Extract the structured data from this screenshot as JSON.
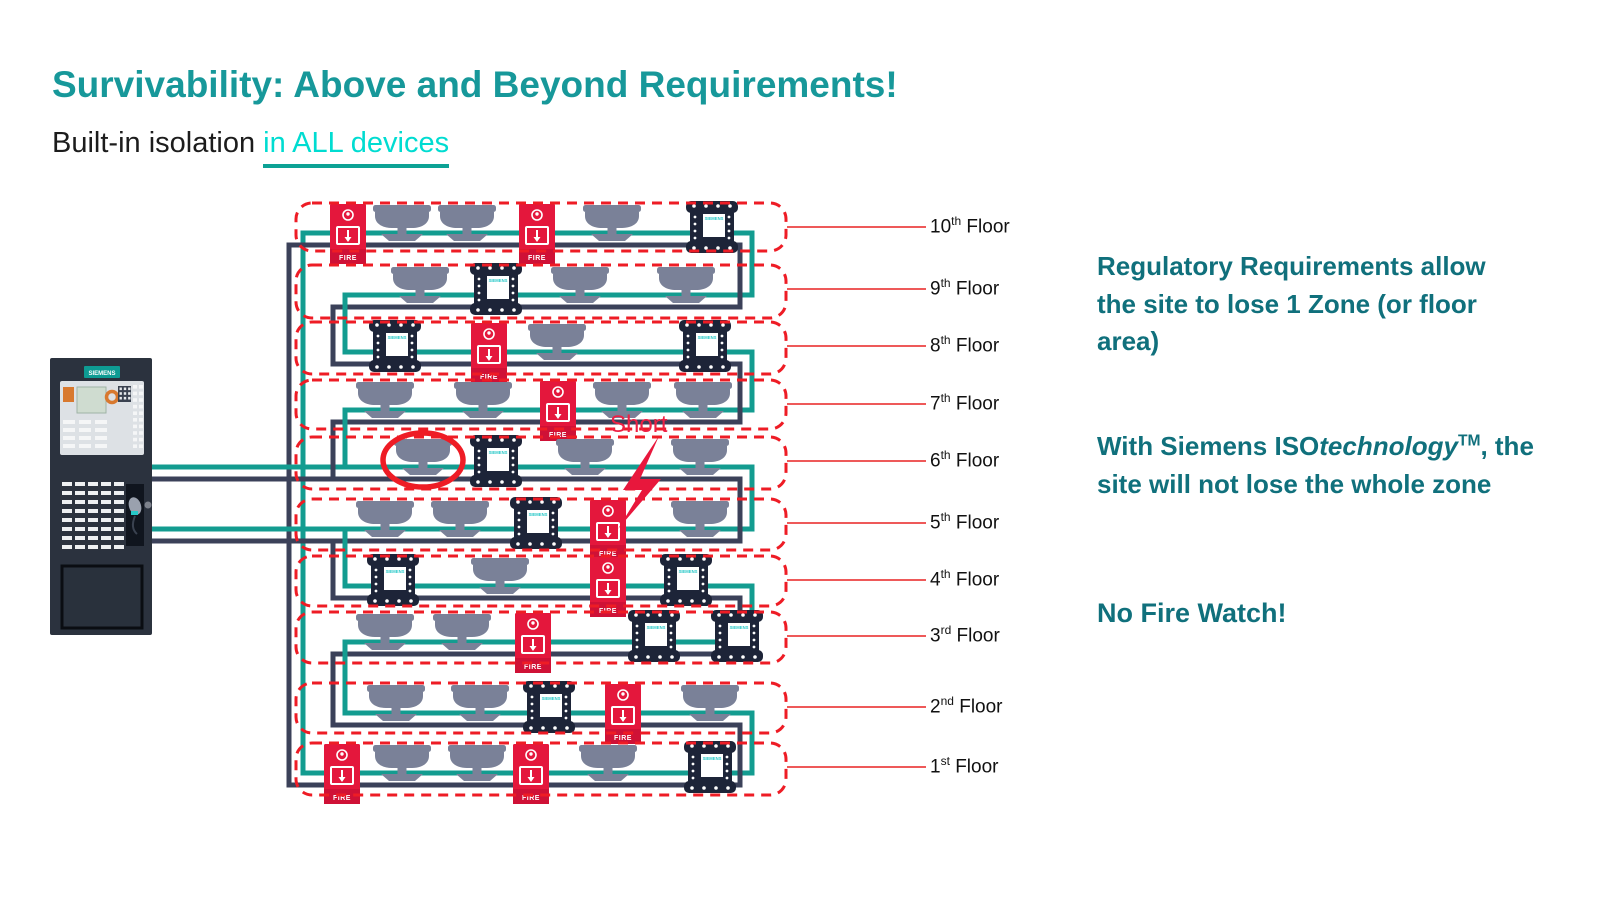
{
  "slide": {
    "title": "Survivability: Above and Beyond Requirements!",
    "subtitle_plain": "Built-in isolation ",
    "subtitle_highlight": "in ALL devices"
  },
  "notes": {
    "regulatory": "Regulatory Requirements allow the site to lose 1 Zone (or floor area)",
    "iso": {
      "pre": "With Siemens ISO",
      "italic": "technology",
      "sup": "TM",
      "post": ", the site will not lose the whole zone"
    },
    "fire_watch": "No Fire Watch!"
  },
  "colors": {
    "title_teal": "#17989a",
    "subtitle_cyan": "#00dcd1",
    "note_teal": "#10707c",
    "zone_red": "#ee1c25",
    "device_crimson": "#e4173c",
    "wire_teal": "#139c90",
    "wire_navy": "#3b4159",
    "smoke_gray": "#7a8198",
    "module_navy": "#1d2438",
    "panel_body": "#2b323e",
    "siemens_cyan": "#27c8c8"
  },
  "diagram": {
    "short_label": "Short",
    "floor_word": "Floor",
    "panel": {
      "brand": "SIEMENS"
    },
    "device_labels": {
      "pull": "FIRE",
      "module": "SIEMENS"
    },
    "circle": {
      "floor_index": 4,
      "device_x": 423
    },
    "floors": [
      {
        "ordinal": "10",
        "suffix": "th",
        "boxY": 203,
        "boxH": 48,
        "devices": [
          {
            "type": "pull",
            "x": 348
          },
          {
            "type": "smoke",
            "x": 402
          },
          {
            "type": "smoke",
            "x": 467
          },
          {
            "type": "pull",
            "x": 537
          },
          {
            "type": "smoke",
            "x": 612
          },
          {
            "type": "module",
            "x": 712
          }
        ]
      },
      {
        "ordinal": "9",
        "suffix": "th",
        "boxY": 265,
        "boxH": 53,
        "devices": [
          {
            "type": "smoke",
            "x": 420
          },
          {
            "type": "module",
            "x": 496
          },
          {
            "type": "smoke",
            "x": 580
          },
          {
            "type": "smoke",
            "x": 686
          }
        ]
      },
      {
        "ordinal": "8",
        "suffix": "th",
        "boxY": 322,
        "boxH": 52,
        "devices": [
          {
            "type": "module",
            "x": 395
          },
          {
            "type": "pull",
            "x": 489
          },
          {
            "type": "smoke",
            "x": 557
          },
          {
            "type": "module",
            "x": 705
          }
        ]
      },
      {
        "ordinal": "7",
        "suffix": "th",
        "boxY": 380,
        "boxH": 49,
        "devices": [
          {
            "type": "smoke",
            "x": 385
          },
          {
            "type": "smoke",
            "x": 483
          },
          {
            "type": "pull",
            "x": 558
          },
          {
            "type": "smoke",
            "x": 622
          },
          {
            "type": "smoke",
            "x": 703
          }
        ]
      },
      {
        "ordinal": "6",
        "suffix": "th",
        "boxY": 437,
        "boxH": 52,
        "devices": [
          {
            "type": "smoke",
            "x": 423
          },
          {
            "type": "module",
            "x": 496
          },
          {
            "type": "smoke",
            "x": 585
          },
          {
            "type": "smoke",
            "x": 700
          }
        ]
      },
      {
        "ordinal": "5",
        "suffix": "th",
        "boxY": 499,
        "boxH": 51,
        "devices": [
          {
            "type": "smoke",
            "x": 385
          },
          {
            "type": "smoke",
            "x": 460
          },
          {
            "type": "module",
            "x": 536
          },
          {
            "type": "pull",
            "x": 608
          },
          {
            "type": "smoke",
            "x": 700
          }
        ]
      },
      {
        "ordinal": "4",
        "suffix": "th",
        "boxY": 556,
        "boxH": 50,
        "devices": [
          {
            "type": "module",
            "x": 393
          },
          {
            "type": "smoke",
            "x": 500
          },
          {
            "type": "pull",
            "x": 608
          },
          {
            "type": "module",
            "x": 686
          }
        ]
      },
      {
        "ordinal": "3",
        "suffix": "rd",
        "boxY": 612,
        "boxH": 51,
        "devices": [
          {
            "type": "smoke",
            "x": 385
          },
          {
            "type": "smoke",
            "x": 462
          },
          {
            "type": "pull",
            "x": 533
          },
          {
            "type": "module",
            "x": 654
          },
          {
            "type": "module",
            "x": 737
          }
        ]
      },
      {
        "ordinal": "2",
        "suffix": "nd",
        "boxY": 683,
        "boxH": 50,
        "devices": [
          {
            "type": "smoke",
            "x": 396
          },
          {
            "type": "smoke",
            "x": 480
          },
          {
            "type": "module",
            "x": 549
          },
          {
            "type": "pull",
            "x": 623
          },
          {
            "type": "smoke",
            "x": 710
          }
        ]
      },
      {
        "ordinal": "1",
        "suffix": "st",
        "boxY": 743,
        "boxH": 52,
        "devices": [
          {
            "type": "pull",
            "x": 342
          },
          {
            "type": "smoke",
            "x": 402
          },
          {
            "type": "smoke",
            "x": 477
          },
          {
            "type": "pull",
            "x": 531
          },
          {
            "type": "smoke",
            "x": 608
          },
          {
            "type": "module",
            "x": 710
          }
        ]
      }
    ]
  }
}
